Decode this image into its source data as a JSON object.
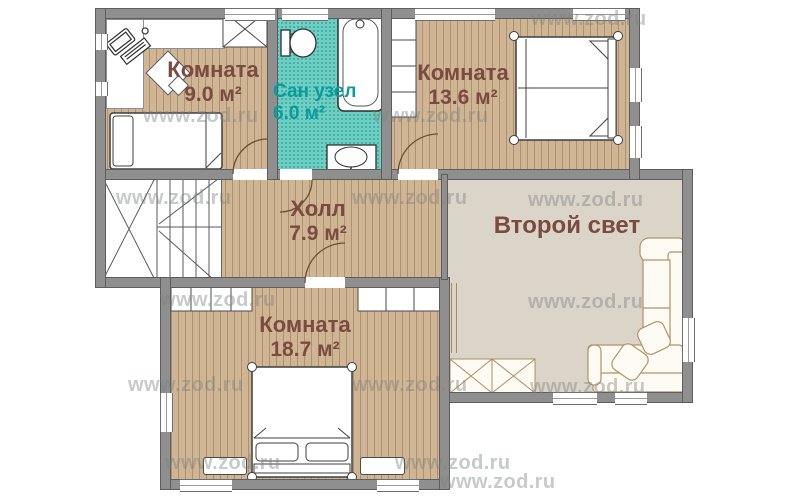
{
  "watermark": "www.zod.ru",
  "rooms": {
    "room_9": {
      "name": "Комната",
      "area": "9.0 м²"
    },
    "bathroom": {
      "name": "Сан узел",
      "area": "6.0 м²"
    },
    "room_13_6": {
      "name": "Комната",
      "area": "13.6 м²"
    },
    "hall": {
      "name": "Холл",
      "area": "7.9 м²"
    },
    "room_18_7": {
      "name": "Комната",
      "area": "18.7 м²"
    },
    "second_light": {
      "name": "Второй свет"
    }
  },
  "colors": {
    "wall": "#8f8f8f",
    "wood_floor": "#cfb594",
    "bathroom_floor": "#6ed0c4",
    "second_light_floor": "#dbd5c9",
    "room_label": "#7b4a40",
    "bathroom_label": "#0b9b9b",
    "watermark": "#7a8080"
  }
}
